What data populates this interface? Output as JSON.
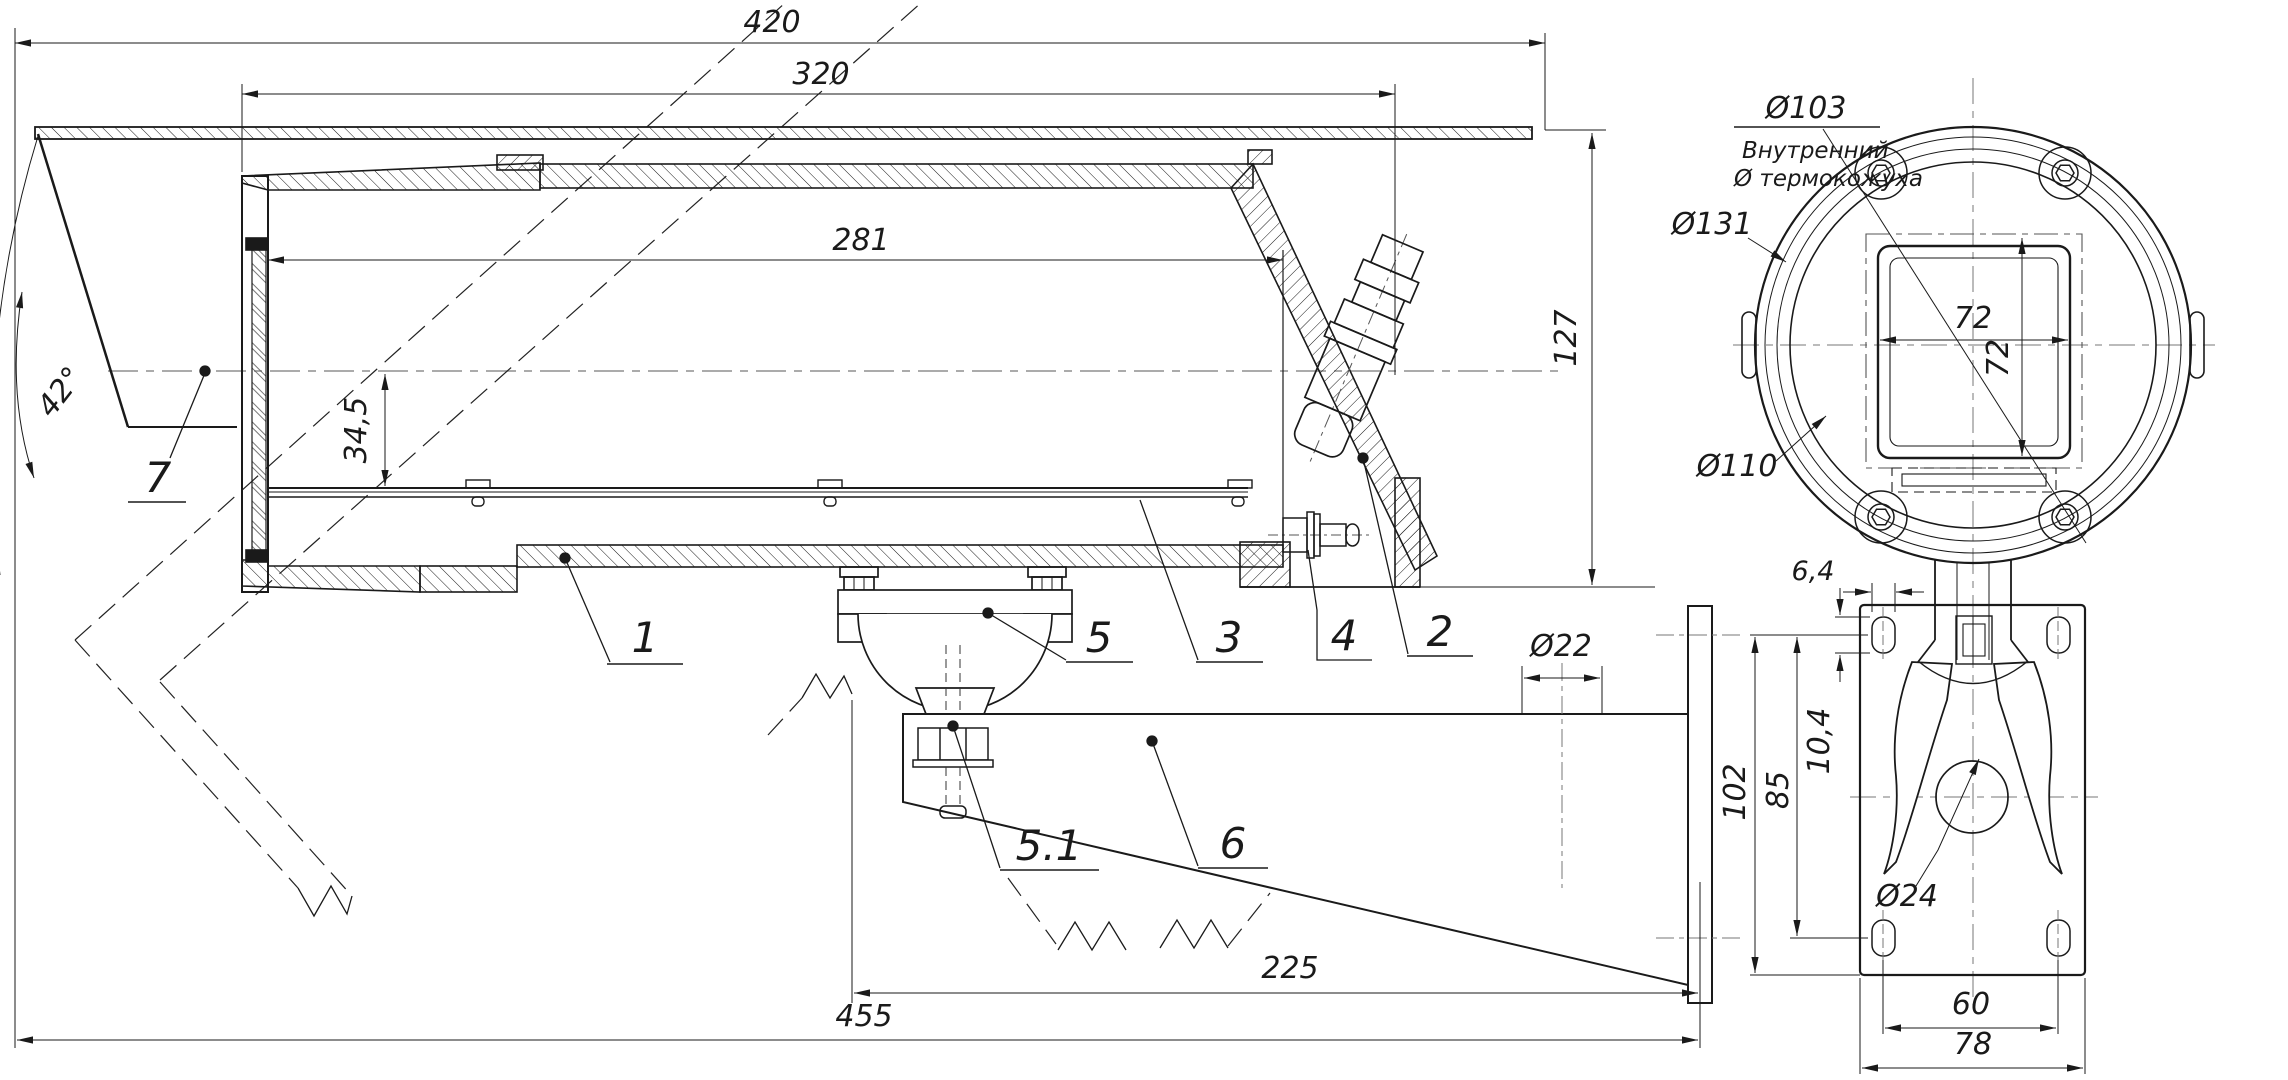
{
  "drawing": {
    "title": "Термокожух — габаритный чертёж",
    "units": "mm"
  },
  "dimensions": {
    "side_view": {
      "total_length": "420",
      "body_length": "320",
      "internal_length": "281",
      "housing_height": "127",
      "view_angle": "42°",
      "axis_to_tray": "34,5",
      "arm_cable_hole": "Ø22",
      "arm_reach": "225",
      "overall_reach": "455"
    },
    "front_view": {
      "inner_diameter": "Ø103",
      "inner_note_line1": "Внутренний",
      "inner_note_line2": "Ø термокожуха",
      "flange_diameter": "Ø131",
      "ring_diameter": "Ø110",
      "window_width": "72",
      "window_height": "72",
      "slot_width": "6,4",
      "plate_height": "102",
      "hole_span_vertical": "85",
      "slot_height": "10,4",
      "fork_hole_diameter": "Ø24",
      "hole_span_horizontal": "60",
      "plate_width": "78"
    }
  },
  "part_labels": {
    "housing": "1",
    "cable_gland": "2",
    "camera_tray": "3",
    "vent_bolt": "4",
    "ball_mount": "5",
    "ball_mount_bolt": "5.1",
    "bracket_arm": "6",
    "front_window": "7"
  }
}
